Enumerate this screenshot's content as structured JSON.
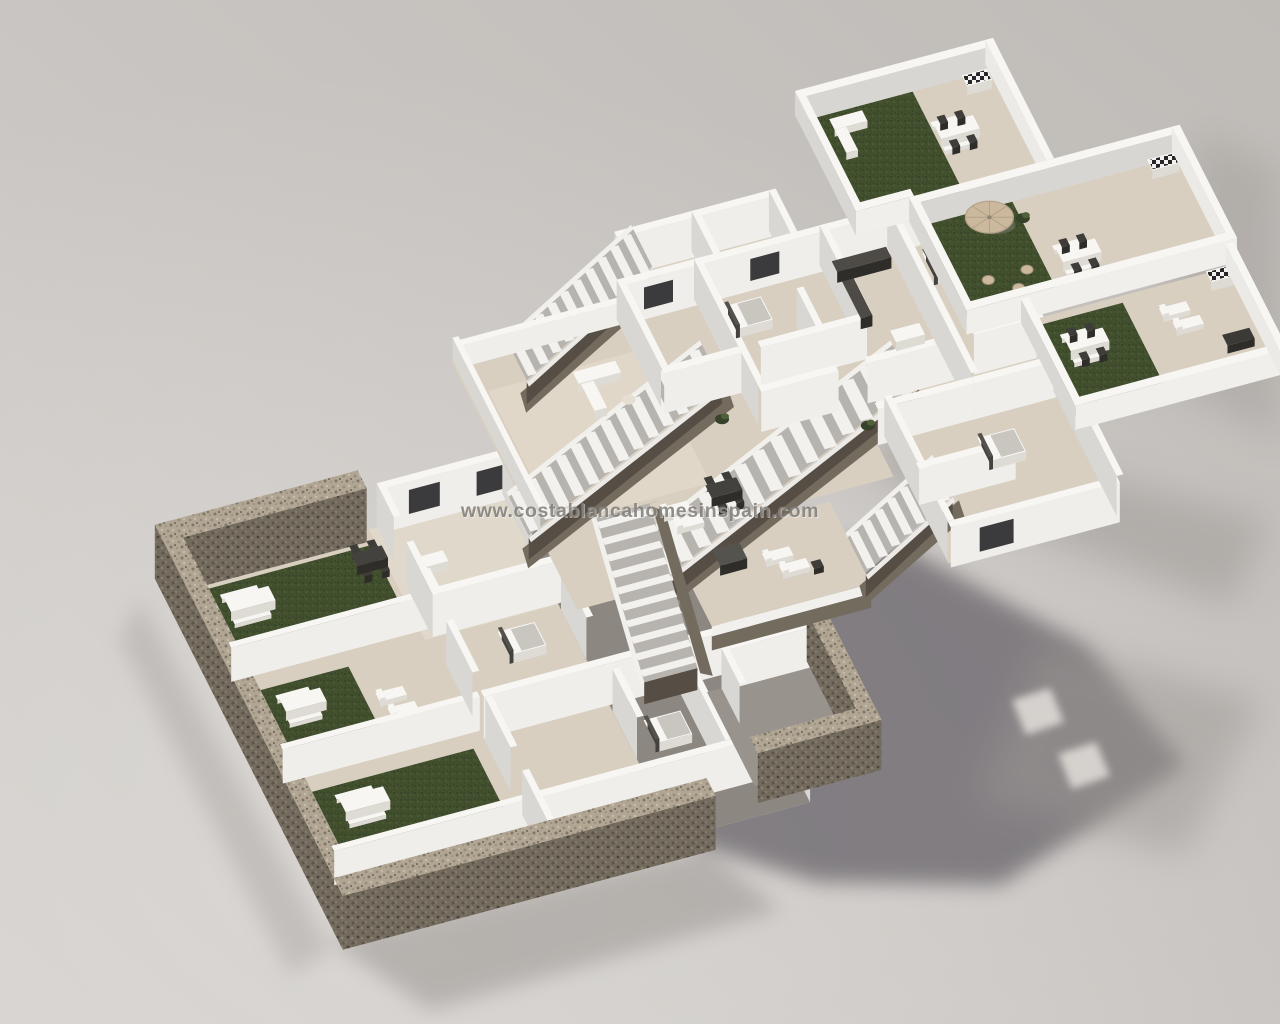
{
  "image": {
    "kind": "3d-floorplan-render",
    "watermark": "www.costablancahomesinspain.com"
  },
  "scene": {
    "blocks": [
      {
        "id": "ground-floor-block"
      },
      {
        "id": "first-floor-block"
      },
      {
        "id": "roof-terrace-block"
      }
    ]
  },
  "palette": {
    "bg_light": "#d7d4d1",
    "bg_mid": "#c9c5c2",
    "bg_dark": "#bcb8b4",
    "wall_top": "#f7f6f3",
    "wall_face_lit": "#efeeea",
    "wall_face_shade": "#d9d7d3",
    "floor_tile": "#d8cfc0",
    "floor_tile_light": "#e8e0d1",
    "floor_dark": "#85817b",
    "grass": "#42502e",
    "grass_dark": "#36422a",
    "stone_top": "#b0a693",
    "stone_mid": "#746b5f",
    "stone_dark": "#564e44",
    "tread": "#f2f1ee",
    "tread_base": "#b7b4af",
    "furn_white": "#f7f6f3",
    "furn_white_side": "#dedbd5",
    "furn_gray": "#908d87",
    "furn_dark": "#3f3d3a",
    "furn_dark_side": "#2e2d2a",
    "furn_beige": "#e6dfd1",
    "tan": "#cbb89d",
    "window_dark": "#2b2b2e",
    "shadow_core": "#6e6b70",
    "shadow_soft": "#9b9793",
    "shadow_gap_light": "#d9d6d2",
    "watermark": "#7f7c78",
    "watermark_halo": "#ffffff"
  }
}
